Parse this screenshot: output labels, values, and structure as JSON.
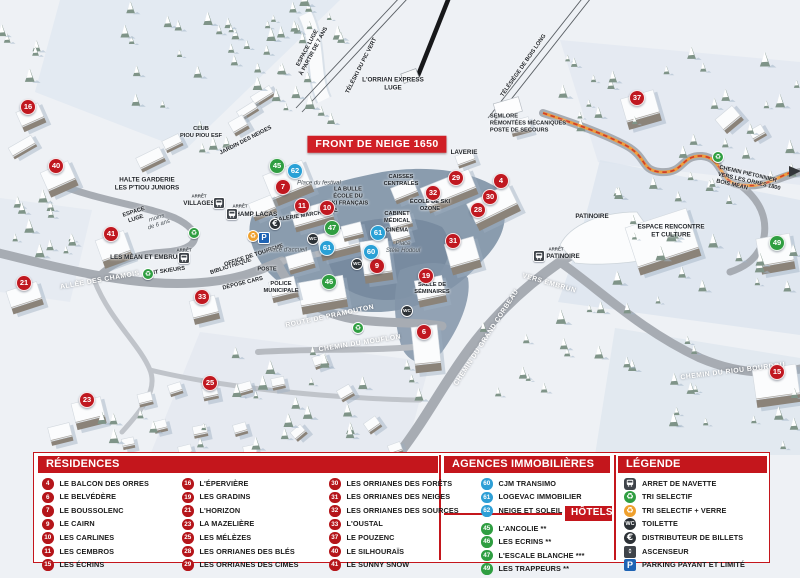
{
  "colors": {
    "accent_red": "#c4161c",
    "banner_red": "#d01f26",
    "marker_red": "#c01820",
    "marker_green": "#2f9e41",
    "marker_blue": "#29a0d6",
    "trail_orange": "#f09c3c",
    "trail_dash_red": "#cf3f2a"
  },
  "map": {
    "banner": "FRONT DE NEIGE 1650",
    "markers": [
      {
        "n": "16",
        "t": "res",
        "x": 28,
        "y": 107
      },
      {
        "n": "40",
        "t": "res",
        "x": 56,
        "y": 166
      },
      {
        "n": "41",
        "t": "res",
        "x": 111,
        "y": 234
      },
      {
        "n": "21",
        "t": "res",
        "x": 24,
        "y": 283
      },
      {
        "n": "33",
        "t": "res",
        "x": 202,
        "y": 297
      },
      {
        "n": "23",
        "t": "res",
        "x": 87,
        "y": 400
      },
      {
        "n": "25",
        "t": "res",
        "x": 210,
        "y": 383
      },
      {
        "n": "7",
        "t": "res",
        "x": 283,
        "y": 187
      },
      {
        "n": "11",
        "t": "res",
        "x": 302,
        "y": 206
      },
      {
        "n": "10",
        "t": "res",
        "x": 327,
        "y": 208
      },
      {
        "n": "9",
        "t": "res",
        "x": 377,
        "y": 266
      },
      {
        "n": "19",
        "t": "res",
        "x": 426,
        "y": 276
      },
      {
        "n": "6",
        "t": "res",
        "x": 424,
        "y": 332
      },
      {
        "n": "29",
        "t": "res",
        "x": 456,
        "y": 178
      },
      {
        "n": "4",
        "t": "res",
        "x": 501,
        "y": 181
      },
      {
        "n": "32",
        "t": "res",
        "x": 433,
        "y": 193
      },
      {
        "n": "30",
        "t": "res",
        "x": 490,
        "y": 197
      },
      {
        "n": "28",
        "t": "res",
        "x": 478,
        "y": 210
      },
      {
        "n": "31",
        "t": "res",
        "x": 453,
        "y": 241
      },
      {
        "n": "37",
        "t": "res",
        "x": 637,
        "y": 98
      },
      {
        "n": "15",
        "t": "res",
        "x": 777,
        "y": 372
      },
      {
        "n": "45",
        "t": "hot",
        "x": 277,
        "y": 166
      },
      {
        "n": "47",
        "t": "hot",
        "x": 332,
        "y": 228
      },
      {
        "n": "46",
        "t": "hot",
        "x": 329,
        "y": 282
      },
      {
        "n": "49",
        "t": "hot",
        "x": 777,
        "y": 243
      },
      {
        "n": "62",
        "t": "agc",
        "x": 295,
        "y": 171
      },
      {
        "n": "61",
        "t": "agc",
        "x": 378,
        "y": 233
      },
      {
        "n": "61",
        "t": "agc",
        "x": 327,
        "y": 248
      },
      {
        "n": "60",
        "t": "agc",
        "x": 371,
        "y": 252
      }
    ],
    "labels": [
      {
        "t": "ESPACE LUGE\nà partir de 7 ans",
        "x": 311,
        "y": 50,
        "r": -62,
        "c": "tiny"
      },
      {
        "t": "TÉLÉSKI DU PIC VERT",
        "x": 362,
        "y": 66,
        "r": -63,
        "c": "tiny"
      },
      {
        "t": "L'ORRIAN EXPRESS\nLUGE",
        "x": 393,
        "y": 84,
        "r": 0,
        "c": ""
      },
      {
        "t": "TÉLÉSIÈGE DE BOIS LONG",
        "x": 524,
        "y": 66,
        "r": -55,
        "c": "tiny"
      },
      {
        "t": "SEMLORE\nREMONTÉES MÉCANIQUES\nPOSTE DE SECOURS",
        "x": 528,
        "y": 124,
        "r": 0,
        "c": "left tiny"
      },
      {
        "t": "CLUB\nPIOU PIOU ESF",
        "x": 201,
        "y": 133,
        "r": 0,
        "c": "tiny"
      },
      {
        "t": "JARDIN DES NEIGES",
        "x": 246,
        "y": 141,
        "r": -27,
        "c": "tiny"
      },
      {
        "t": "HALTE GARDERIE\nLES P'TIOU JUNIORS",
        "x": 147,
        "y": 184,
        "r": 0,
        "c": ""
      },
      {
        "t": "ESPACE\nLUGE",
        "x": 135,
        "y": 216,
        "r": -18,
        "c": "tiny"
      },
      {
        "t": "moins\nde 6 ans",
        "x": 158,
        "y": 222,
        "r": -18,
        "c": "it"
      },
      {
        "t": "ARRÊT",
        "x": 199,
        "y": 196,
        "r": 0,
        "c": "tiny2"
      },
      {
        "t": "VILLAGES",
        "x": 199,
        "y": 204,
        "r": 0,
        "c": ""
      },
      {
        "t": "ARRÊT",
        "x": 184,
        "y": 250,
        "r": 0,
        "c": "tiny2"
      },
      {
        "t": "LES MÉAN ET EMBRUN",
        "x": 146,
        "y": 258,
        "r": 0,
        "c": ""
      },
      {
        "t": "ALLÉE DES CHAMOIS",
        "x": 100,
        "y": 281,
        "r": -10,
        "c": "road"
      },
      {
        "t": "PONT SKIEURS",
        "x": 164,
        "y": 272,
        "r": -8,
        "c": "tiny"
      },
      {
        "t": "BIBLIOTHÈQUE",
        "x": 231,
        "y": 267,
        "r": -18,
        "c": "tiny"
      },
      {
        "t": "OFFICE DE TOURISME",
        "x": 254,
        "y": 256,
        "r": -18,
        "c": "tiny"
      },
      {
        "t": "POSTE",
        "x": 267,
        "y": 270,
        "r": 0,
        "c": "tiny"
      },
      {
        "t": "DÉPOSE CARS",
        "x": 243,
        "y": 284,
        "r": -14,
        "c": "tiny"
      },
      {
        "t": "POLICE\nMUNICIPALE",
        "x": 281,
        "y": 288,
        "r": 0,
        "c": "tiny"
      },
      {
        "t": "Place d'accueil",
        "x": 287,
        "y": 251,
        "r": 0,
        "c": "it"
      },
      {
        "t": "ARRÊT",
        "x": 240,
        "y": 206,
        "r": 0,
        "c": "tiny2"
      },
      {
        "t": "CHAMP LACAS",
        "x": 254,
        "y": 215,
        "r": 0,
        "c": ""
      },
      {
        "t": "GALERIE MARCHANDE",
        "x": 306,
        "y": 216,
        "r": -9,
        "c": "tiny"
      },
      {
        "t": "Place du festival",
        "x": 319,
        "y": 184,
        "r": 0,
        "c": "it"
      },
      {
        "t": "LA BULLE\nÉCOLE DU\nSKI FRANÇAIS",
        "x": 348,
        "y": 197,
        "r": 0,
        "c": "tiny"
      },
      {
        "t": "CAISSES\nCENTRALES",
        "x": 401,
        "y": 181,
        "r": 0,
        "c": "tiny"
      },
      {
        "t": "CABINET\nMÉDICAL",
        "x": 397,
        "y": 218,
        "r": 0,
        "c": "tiny"
      },
      {
        "t": "CINÉMA",
        "x": 397,
        "y": 231,
        "r": 0,
        "c": "tiny"
      },
      {
        "t": "Place\nStèle Hodoul",
        "x": 403,
        "y": 248,
        "r": 0,
        "c": "it"
      },
      {
        "t": "ÉCOLE DE SKI\nOZONE",
        "x": 430,
        "y": 206,
        "r": 0,
        "c": "tiny"
      },
      {
        "t": "LAVERIE",
        "x": 464,
        "y": 153,
        "r": 0,
        "c": ""
      },
      {
        "t": "SALLE DE\nSÉMINAIRES",
        "x": 432,
        "y": 289,
        "r": 0,
        "c": "tiny"
      },
      {
        "t": "ROUTE DE PRAMOUTON",
        "x": 330,
        "y": 317,
        "r": -12,
        "c": "road"
      },
      {
        "t": "CHEMIN DU MOUFLON",
        "x": 360,
        "y": 344,
        "r": -9,
        "c": "road"
      },
      {
        "t": "CHEMIN DU GRAND CORBEAU",
        "x": 487,
        "y": 338,
        "r": -57,
        "c": "road"
      },
      {
        "t": "CHEMIN DU RIOU BOURDOU",
        "x": 733,
        "y": 372,
        "r": -7,
        "c": "road"
      },
      {
        "t": "VERS EMBRUN",
        "x": 549,
        "y": 284,
        "r": 16,
        "c": "road"
      },
      {
        "t": "ARRÊT",
        "x": 556,
        "y": 249,
        "r": 0,
        "c": "tiny2"
      },
      {
        "t": "PATINOIRE",
        "x": 563,
        "y": 257,
        "r": 0,
        "c": ""
      },
      {
        "t": "PATINOIRE",
        "x": 592,
        "y": 217,
        "r": 0,
        "c": ""
      },
      {
        "t": "ESPACE RENCONTRE\nET CULTURE",
        "x": 671,
        "y": 231,
        "r": 0,
        "c": ""
      },
      {
        "t": "CHEMIN PIÉTONNIER\nVERS LES ORRES 1800\nBOIS MÉAN",
        "x": 749,
        "y": 182,
        "r": 13,
        "c": "tiny left"
      }
    ],
    "icons": [
      {
        "t": "bus",
        "x": 219,
        "y": 203
      },
      {
        "t": "bus",
        "x": 184,
        "y": 258
      },
      {
        "t": "bus",
        "x": 232,
        "y": 214
      },
      {
        "t": "bus",
        "x": 539,
        "y": 256
      },
      {
        "t": "recycle",
        "x": 194,
        "y": 233
      },
      {
        "t": "recycle",
        "x": 148,
        "y": 274
      },
      {
        "t": "recycle",
        "x": 358,
        "y": 328
      },
      {
        "t": "recycle",
        "x": 718,
        "y": 157
      },
      {
        "t": "recycle_verre",
        "x": 253,
        "y": 236
      },
      {
        "t": "parking",
        "x": 264,
        "y": 238
      },
      {
        "t": "euro",
        "x": 275,
        "y": 224
      },
      {
        "t": "wc",
        "x": 313,
        "y": 239
      },
      {
        "t": "wc",
        "x": 357,
        "y": 264
      },
      {
        "t": "wc",
        "x": 407,
        "y": 311
      }
    ]
  },
  "legend_panel": {
    "residences": {
      "title": "RÉSIDENCES",
      "items": [
        {
          "num": "4",
          "label": "LE BALCON DES ORRES"
        },
        {
          "num": "6",
          "label": "LE BELVÉDÈRE"
        },
        {
          "num": "7",
          "label": "LE BOUSSOLENC"
        },
        {
          "num": "9",
          "label": "LE CAIRN"
        },
        {
          "num": "10",
          "label": "LES CARLINES"
        },
        {
          "num": "11",
          "label": "LES CEMBROS"
        },
        {
          "num": "15",
          "label": "LES ÉCRINS"
        },
        {
          "num": "16",
          "label": "L'ÉPERVIÈRE"
        },
        {
          "num": "19",
          "label": "LES GRADINS"
        },
        {
          "num": "21",
          "label": "L'HORIZON"
        },
        {
          "num": "23",
          "label": "LA MAZELIÈRE"
        },
        {
          "num": "25",
          "label": "LES MÉLÈZES"
        },
        {
          "num": "28",
          "label": "LES ORRIANES DES BLÉS"
        },
        {
          "num": "29",
          "label": "LES ORRIANES DES CIMES"
        },
        {
          "num": "30",
          "label": "LES ORRIANES DES FORÊTS"
        },
        {
          "num": "31",
          "label": "LES ORRIANES DES NEIGES"
        },
        {
          "num": "32",
          "label": "LES ORRIANES DES SOURCES"
        },
        {
          "num": "33",
          "label": "L'OUSTAL"
        },
        {
          "num": "37",
          "label": "LE POUZENC"
        },
        {
          "num": "40",
          "label": "LE SILHOURAÏS"
        },
        {
          "num": "41",
          "label": "LE SUNNY SNOW"
        }
      ]
    },
    "agences": {
      "title": "AGENCES IMMOBILIÈRES",
      "items": [
        {
          "num": "60",
          "label": "CJM TRANSIMO"
        },
        {
          "num": "61",
          "label": "LOGEVAC IMMOBILIER"
        },
        {
          "num": "62",
          "label": "NEIGE ET SOLEIL"
        }
      ]
    },
    "hotels": {
      "title": "HÔTELS",
      "items": [
        {
          "num": "45",
          "label": "L'ANCOLIE **"
        },
        {
          "num": "46",
          "label": "LES ECRINS **"
        },
        {
          "num": "47",
          "label": "L'ESCALE BLANCHE ***"
        },
        {
          "num": "49",
          "label": "LES TRAPPEURS **"
        }
      ]
    },
    "legende": {
      "title": "LÉGENDE",
      "items": [
        {
          "icon": "bus",
          "label": "ARRET DE NAVETTE"
        },
        {
          "icon": "recycle",
          "label": "TRI SELECTIF"
        },
        {
          "icon": "recycle_verre",
          "label": "TRI SELECTIF + VERRE"
        },
        {
          "icon": "wc",
          "label": "TOILETTE"
        },
        {
          "icon": "euro",
          "label": "DISTRIBUTEUR DE BILLETS"
        },
        {
          "icon": "elevator",
          "label": "ASCENSEUR"
        },
        {
          "icon": "parking",
          "label": "PARKING PAYANT ET LIMITÉ"
        }
      ]
    }
  }
}
